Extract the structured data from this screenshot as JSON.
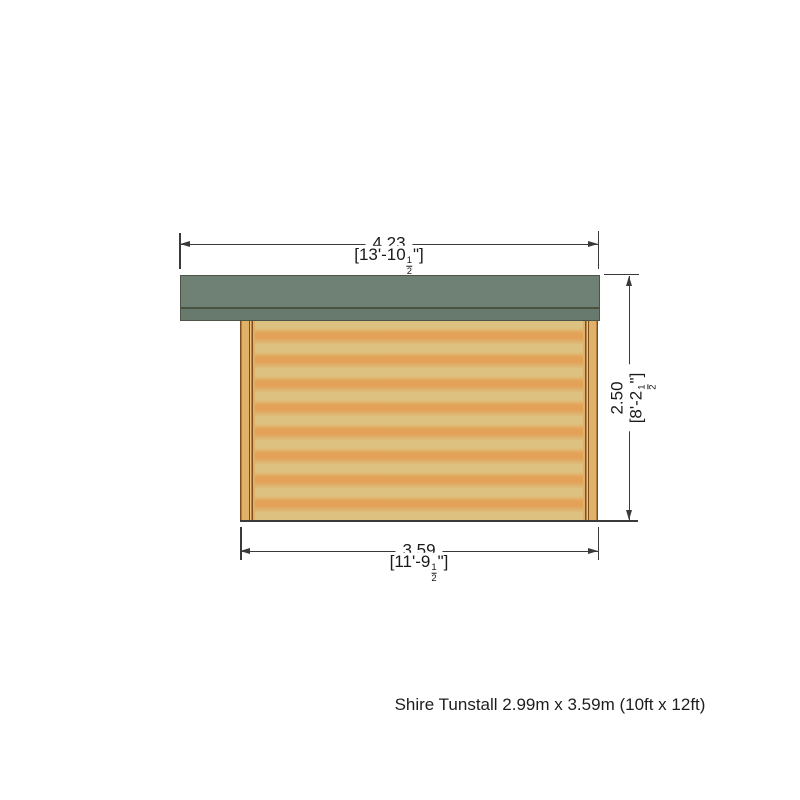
{
  "diagram": {
    "type": "product-dimension-elevation",
    "caption": "Shire Tunstall 2.99m x 3.59m (10ft x 12ft)",
    "dimensions": {
      "overall_width": {
        "metric_m": "4.23",
        "imperial_prefix": "[13'-10",
        "fraction_numerator": "1",
        "fraction_denominator": "2",
        "imperial_suffix": "\"]"
      },
      "height": {
        "metric_m": "2.50",
        "imperial_prefix": "[8'-2",
        "fraction_numerator": "1",
        "fraction_denominator": "2",
        "imperial_suffix": "\"]"
      },
      "base_width": {
        "metric_m": "3.59",
        "imperial_prefix": "[11'-9",
        "fraction_numerator": "1",
        "fraction_denominator": "2",
        "imperial_suffix": "\"]"
      }
    },
    "colors": {
      "roof_main": "#6f8074",
      "roof_fascia": "#687a6d",
      "wall_light": "#dcc181",
      "wall_band": "#e3a258",
      "post_wood": "#e2b168",
      "post_line": "#7d4f1e",
      "dim_line": "#3a3a3a",
      "text": "#1a1a1a"
    }
  }
}
